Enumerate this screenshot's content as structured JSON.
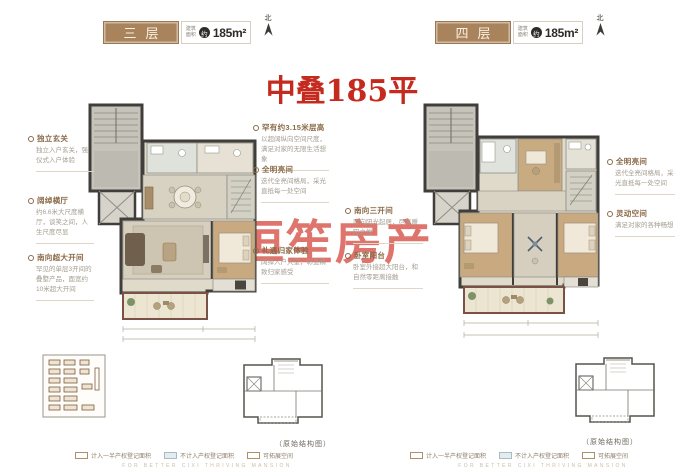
{
  "page": {
    "watermark_title": "中叠185平",
    "watermark_brand": "恒笙房产",
    "structure_caption": "（原始结构图）",
    "footer_text": "FOR BETTER CIXI THRIVING MANSION",
    "colors": {
      "badge_brown": "#a9835c",
      "title_red": "#c42a1e",
      "watermark_red": "#d9564e",
      "heading_brown": "#8a6a48"
    }
  },
  "north_label": "北",
  "area_box": {
    "prefix_line1": "建筑",
    "prefix_line2": "面积",
    "circle": "约",
    "value": "185m²"
  },
  "panels": [
    {
      "floor_label": "三层",
      "left_annotations": [
        {
          "heading": "独立玄关",
          "body": "独立入户玄关，强仪式入户体验"
        },
        {
          "heading": "阔绰横厅",
          "body": "约6.6米大尺度横厅，谈笑之间，人生尺度尽显"
        },
        {
          "heading": "南向超大开间",
          "body": "罕见的单层3开间的叠墅产品，面宽约10米超大开间"
        }
      ],
      "right_annotations": [
        {
          "heading": "罕有约3.15米层高",
          "body": "以超阔纵向空间尺度，满足对家的无限生活想象"
        },
        {
          "heading": "全明亮间",
          "body": "迭代全亮间格局，采光直抵每一处空间"
        },
        {
          "heading": "礼遇归家体验",
          "body": "阔绰入户大堂，彰显精致归家感受"
        }
      ]
    },
    {
      "floor_label": "四层",
      "left_annotations": [
        {
          "heading": "南向三开间",
          "body": "南向阳光起居，尽享暖阳之悦"
        },
        {
          "heading": "卧室阳台",
          "body": "卧室外接超大阳台，和自然零距离接触"
        }
      ],
      "right_annotations": [
        {
          "heading": "全明亮间",
          "body": "迭代全亮间格局，采光直抵每一处空间"
        },
        {
          "heading": "灵动空间",
          "body": "满足对家的各种畅想"
        }
      ]
    }
  ],
  "legend": {
    "items": [
      "计入一半产权登记面积",
      "不计入产权登记面积",
      "可拓展空间"
    ]
  }
}
